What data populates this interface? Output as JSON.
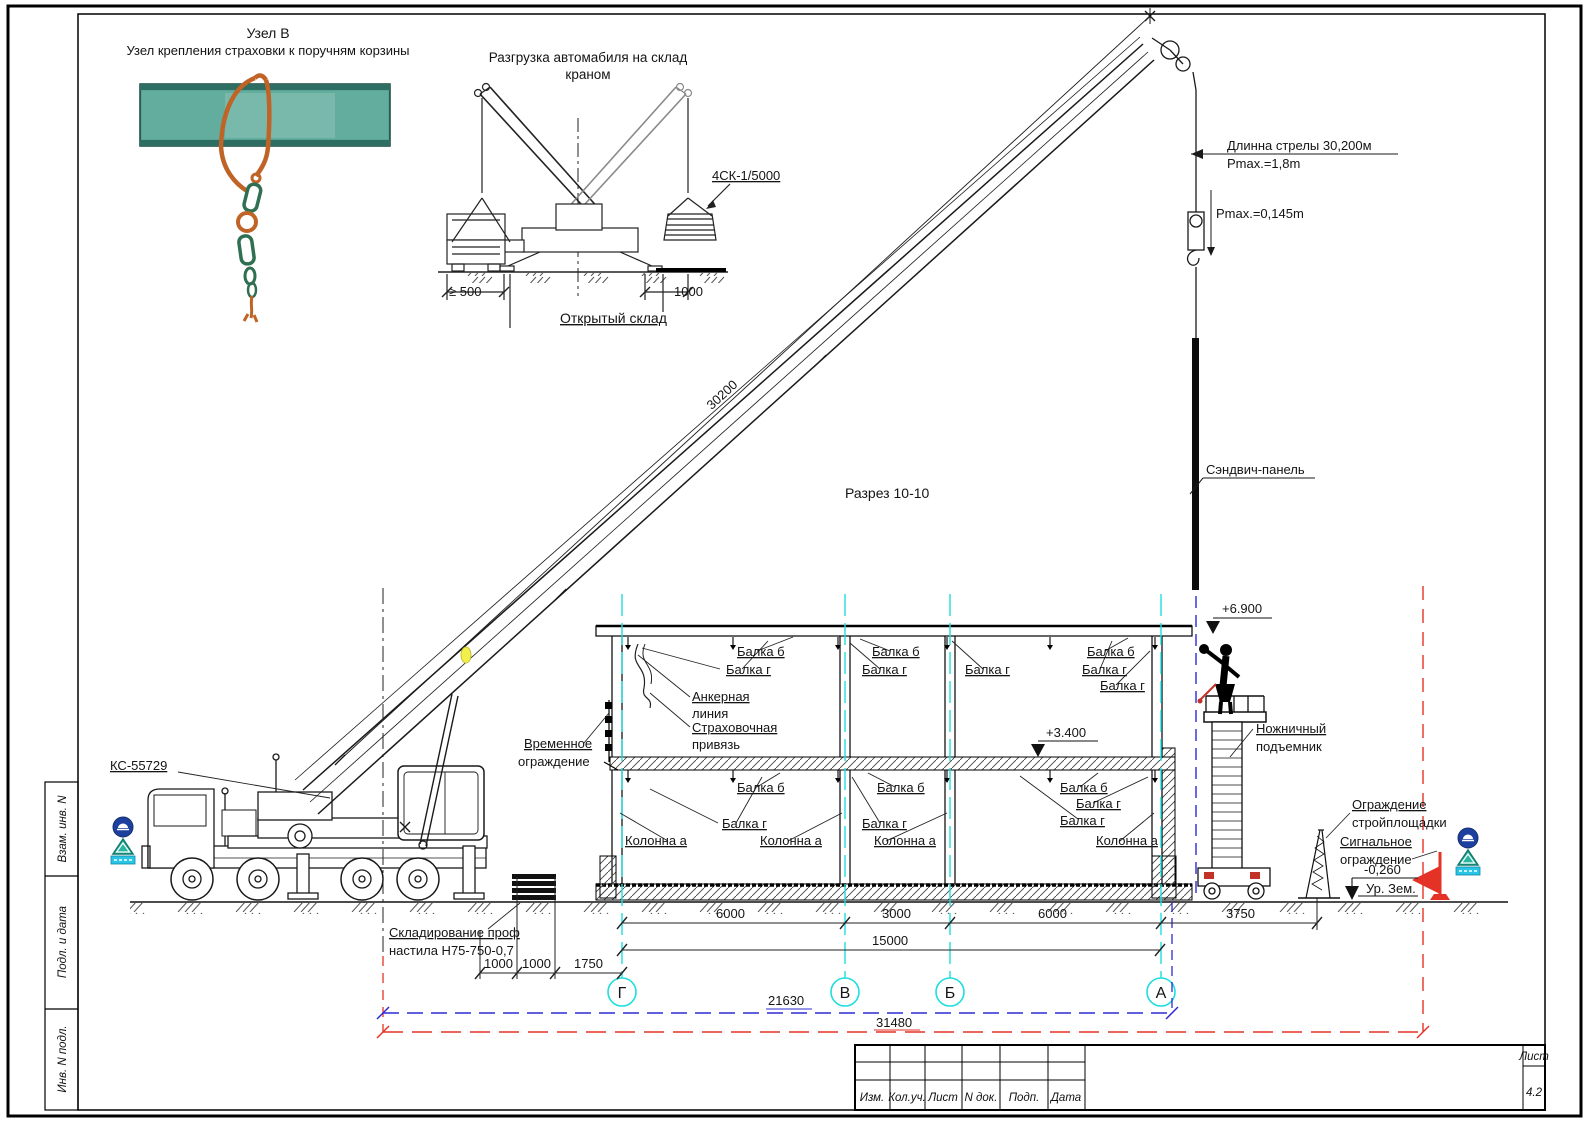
{
  "sheet": {
    "list_label": "Лист",
    "list_value": "4.2"
  },
  "title_block": {
    "col1": "Изм.",
    "col2": "Кол.уч.",
    "col3": "Лист",
    "col4": "N док.",
    "col5": "Подп.",
    "col6": "Дата"
  },
  "stamp": {
    "cell1": "Взам. инв. N",
    "cell2": "Подл. и дата",
    "cell3": "Инв. N подл."
  },
  "colors": {
    "axis_cyan": "#1edede",
    "dim_blue": "#2b2bd5",
    "dim_red": "#e53226",
    "sign_blue": "#1d3f9e",
    "sign_teal": "#2ab5a0",
    "banner_cyan": "#29c5e6",
    "beam_teal": "#58a496",
    "rope_orange": "#bf6327",
    "panel_black": "#0d0d0d"
  },
  "labels": [
    {
      "n": "node-b-title-1",
      "t": "Узел В",
      "x": 268,
      "y": 38,
      "a": "m",
      "fs": 14
    },
    {
      "n": "node-b-title-2",
      "t": "Узел крепления страховки к поручням корзины",
      "x": 268,
      "y": 55,
      "a": "m",
      "fs": 13
    },
    {
      "n": "unload-title-1",
      "t": "Разгрузка автомабиля на склад",
      "x": 588,
      "y": 62,
      "a": "m",
      "fs": 13.5
    },
    {
      "n": "unload-title-2",
      "t": "краном",
      "x": 588,
      "y": 79,
      "a": "m",
      "fs": 13.5
    },
    {
      "n": "sling-type-label",
      "t": "4СК-1/5000",
      "x": 712,
      "y": 180,
      "u": 1
    },
    {
      "n": "dim-offset-500",
      "t": "≥ 500",
      "x": 449,
      "y": 296
    },
    {
      "n": "dim-storage-1000",
      "t": "1000",
      "x": 674,
      "y": 296
    },
    {
      "n": "open-storage-label",
      "t": "Открытый склад",
      "x": 560,
      "y": 323,
      "fs": 14,
      "u": 1
    },
    {
      "n": "crane-model-label",
      "t": "КС-55729",
      "x": 110,
      "y": 770,
      "u": 1
    },
    {
      "n": "boom-length-dim",
      "t": "30200",
      "x": 725,
      "y": 398,
      "a": "m",
      "r": -42.5
    },
    {
      "n": "boom-length-note",
      "t": "Длинна стрелы 30,200м",
      "x": 1227,
      "y": 150
    },
    {
      "n": "boom-pmax-note",
      "t": "Pmax.=1,8m",
      "x": 1227,
      "y": 168
    },
    {
      "n": "hook-pmax-note",
      "t": "Pmax.=0,145m",
      "x": 1216,
      "y": 218
    },
    {
      "n": "sandwich-panel-label",
      "t": "Сэндвич-панель",
      "x": 1206,
      "y": 474
    },
    {
      "n": "section-view-title",
      "t": "Разрез 10-10",
      "x": 845,
      "y": 498,
      "fs": 14
    },
    {
      "n": "level-roof-mark",
      "t": "+6.900",
      "x": 1222,
      "y": 613
    },
    {
      "n": "level-floor-mark",
      "t": "+3.400",
      "x": 1046,
      "y": 737
    },
    {
      "n": "level-ground-value",
      "t": "-0,260",
      "x": 1364,
      "y": 874
    },
    {
      "n": "level-ground-name",
      "t": "Ур. Зем.",
      "x": 1366,
      "y": 893
    },
    {
      "n": "beam-b-upper-1",
      "t": "Балка б",
      "x": 737,
      "y": 656,
      "u": 1
    },
    {
      "n": "beam-b-upper-2",
      "t": "Балка б",
      "x": 872,
      "y": 656,
      "u": 1
    },
    {
      "n": "beam-b-upper-3",
      "t": "Балка б",
      "x": 1087,
      "y": 656,
      "u": 1
    },
    {
      "n": "beam-g-upper-1",
      "t": "Балка г",
      "x": 726,
      "y": 674,
      "u": 1
    },
    {
      "n": "beam-g-upper-2",
      "t": "Балка г",
      "x": 862,
      "y": 674,
      "u": 1
    },
    {
      "n": "beam-g-upper-3",
      "t": "Балка г",
      "x": 965,
      "y": 674,
      "u": 1
    },
    {
      "n": "beam-g-upper-4",
      "t": "Балка г",
      "x": 1082,
      "y": 674,
      "u": 1
    },
    {
      "n": "beam-g-upper-5",
      "t": "Балка г",
      "x": 1100,
      "y": 690,
      "u": 1
    },
    {
      "n": "anchor-line-label-1",
      "t": "Анкерная",
      "x": 692,
      "y": 701,
      "u": 1
    },
    {
      "n": "anchor-line-label-2",
      "t": "линия",
      "x": 692,
      "y": 718
    },
    {
      "n": "harness-label-1",
      "t": "Страховочная",
      "x": 692,
      "y": 732,
      "u": 1
    },
    {
      "n": "harness-label-2",
      "t": "привязь",
      "x": 692,
      "y": 749
    },
    {
      "n": "temp-fence-label-1",
      "t": "Временное",
      "x": 524,
      "y": 748,
      "u": 1
    },
    {
      "n": "temp-fence-label-2",
      "t": "ограждение",
      "x": 518,
      "y": 766
    },
    {
      "n": "beam-b-lower-1",
      "t": "Балка б",
      "x": 737,
      "y": 792,
      "u": 1
    },
    {
      "n": "beam-b-lower-2",
      "t": "Балка б",
      "x": 877,
      "y": 792,
      "u": 1
    },
    {
      "n": "beam-b-lower-3",
      "t": "Балка б",
      "x": 1060,
      "y": 792,
      "u": 1
    },
    {
      "n": "beam-g-lower-1",
      "t": "Балка г",
      "x": 722,
      "y": 828,
      "u": 1
    },
    {
      "n": "beam-g-lower-2",
      "t": "Балка г",
      "x": 862,
      "y": 828,
      "u": 1
    },
    {
      "n": "beam-g-lower-3",
      "t": "Балка г",
      "x": 1076,
      "y": 808,
      "u": 1
    },
    {
      "n": "beam-g-lower-4",
      "t": "Балка г",
      "x": 1060,
      "y": 825,
      "u": 1
    },
    {
      "n": "column-a-label-1",
      "t": "Колонна а",
      "x": 625,
      "y": 845,
      "u": 1
    },
    {
      "n": "column-a-label-2",
      "t": "Колонна а",
      "x": 760,
      "y": 845,
      "u": 1
    },
    {
      "n": "column-a-label-3",
      "t": "Колонна а",
      "x": 874,
      "y": 845,
      "u": 1
    },
    {
      "n": "column-a-label-4",
      "t": "Колонна а",
      "x": 1096,
      "y": 845,
      "u": 1
    },
    {
      "n": "scissor-lift-label-1",
      "t": "Ножничный",
      "x": 1256,
      "y": 733,
      "u": 1
    },
    {
      "n": "scissor-lift-label-2",
      "t": "подъемник",
      "x": 1256,
      "y": 751
    },
    {
      "n": "site-fence-label-1",
      "t": "Ограждение",
      "x": 1352,
      "y": 809,
      "u": 1
    },
    {
      "n": "site-fence-label-2",
      "t": "стройплощадки",
      "x": 1352,
      "y": 827
    },
    {
      "n": "signal-fence-label-1",
      "t": "Сигнальное",
      "x": 1340,
      "y": 846,
      "u": 1
    },
    {
      "n": "signal-fence-label-2",
      "t": "ограждение",
      "x": 1340,
      "y": 864
    },
    {
      "n": "decking-label-1",
      "t": "Складирование проф",
      "x": 389,
      "y": 937,
      "u": 1
    },
    {
      "n": "decking-label-2",
      "t": "настила Н75-750-0,7",
      "x": 389,
      "y": 955
    },
    {
      "n": "dim-1000-a",
      "t": "1000",
      "x": 484,
      "y": 968
    },
    {
      "n": "dim-1000-b",
      "t": "1000",
      "x": 522,
      "y": 968
    },
    {
      "n": "dim-1750",
      "t": "1750",
      "x": 574,
      "y": 968
    },
    {
      "n": "dim-6000-a",
      "t": "6000",
      "x": 716,
      "y": 918
    },
    {
      "n": "dim-3000",
      "t": "3000",
      "x": 882,
      "y": 918
    },
    {
      "n": "dim-6000-b",
      "t": "6000",
      "x": 1038,
      "y": 918
    },
    {
      "n": "dim-3750",
      "t": "3750",
      "x": 1226,
      "y": 918
    },
    {
      "n": "dim-15000",
      "t": "15000",
      "x": 872,
      "y": 945
    },
    {
      "n": "dim-21630",
      "t": "21630",
      "x": 768,
      "y": 1005,
      "c": "blue"
    },
    {
      "n": "dim-31480",
      "t": "31480",
      "x": 876,
      "y": 1027,
      "c": "red"
    },
    {
      "n": "axis-letter-g",
      "t": "Г",
      "x": 622,
      "y": 998,
      "a": "m",
      "fs": 16,
      "c": "axis"
    },
    {
      "n": "axis-letter-v",
      "t": "В",
      "x": 845,
      "y": 998,
      "a": "m",
      "fs": 16,
      "c": "axis"
    },
    {
      "n": "axis-letter-b",
      "t": "Б",
      "x": 950,
      "y": 998,
      "a": "m",
      "fs": 16,
      "c": "axis"
    },
    {
      "n": "axis-letter-a",
      "t": "А",
      "x": 1161,
      "y": 998,
      "a": "m",
      "fs": 16,
      "c": "axis"
    }
  ]
}
